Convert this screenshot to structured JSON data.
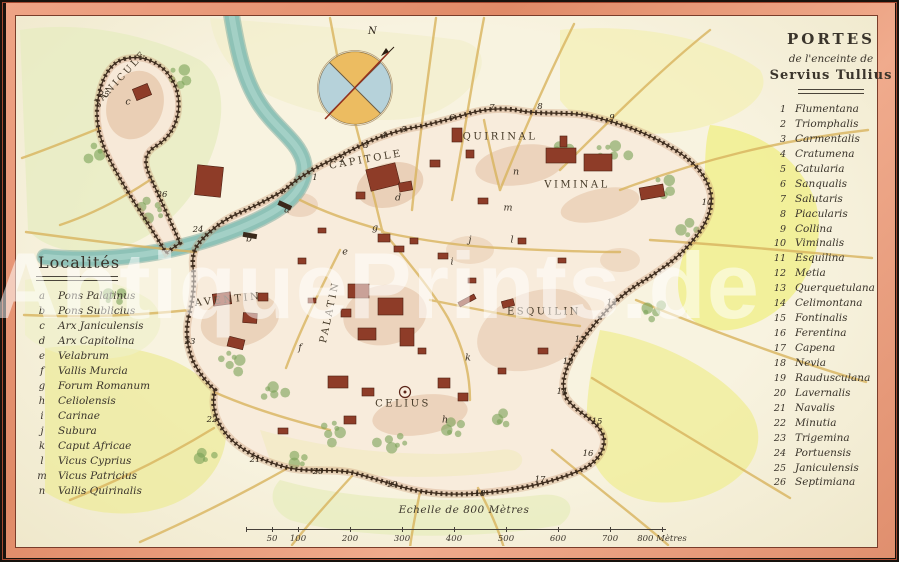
{
  "watermark": "AntiquePrints.de",
  "compass": {
    "north_label": "N"
  },
  "portes": {
    "title": "PORTES",
    "subtitle": "de l'enceinte de",
    "name": "Servius Tullius",
    "items": [
      {
        "n": "1",
        "name": "Flumentana"
      },
      {
        "n": "2",
        "name": "Triomphalis"
      },
      {
        "n": "3",
        "name": "Carmentalis"
      },
      {
        "n": "4",
        "name": "Cratumena"
      },
      {
        "n": "5",
        "name": "Catularia"
      },
      {
        "n": "6",
        "name": "Sanqualis"
      },
      {
        "n": "7",
        "name": "Salutaris"
      },
      {
        "n": "8",
        "name": "Piacularis"
      },
      {
        "n": "9",
        "name": "Collina"
      },
      {
        "n": "10",
        "name": "Viminalis"
      },
      {
        "n": "11",
        "name": "Esquilina"
      },
      {
        "n": "12",
        "name": "Metia"
      },
      {
        "n": "13",
        "name": "Querquetulana"
      },
      {
        "n": "14",
        "name": "Celimontana"
      },
      {
        "n": "15",
        "name": "Fontinalis"
      },
      {
        "n": "16",
        "name": "Ferentina"
      },
      {
        "n": "17",
        "name": "Capena"
      },
      {
        "n": "18",
        "name": "Nevia"
      },
      {
        "n": "19",
        "name": "Raudusculana"
      },
      {
        "n": "20",
        "name": "Lavernalis"
      },
      {
        "n": "21",
        "name": "Navalis"
      },
      {
        "n": "22",
        "name": "Minutia"
      },
      {
        "n": "23",
        "name": "Trigemina"
      },
      {
        "n": "24",
        "name": "Portuensis"
      },
      {
        "n": "25",
        "name": "Janiculensis"
      },
      {
        "n": "26",
        "name": "Septimiana"
      }
    ]
  },
  "localites": {
    "title": "Localités",
    "items": [
      {
        "letter": "a",
        "name": "Pons Palatinus"
      },
      {
        "letter": "b",
        "name": "Pons Sublicius"
      },
      {
        "letter": "c",
        "name": "Arx Janiculensis"
      },
      {
        "letter": "d",
        "name": "Arx Capitolina"
      },
      {
        "letter": "e",
        "name": "Velabrum"
      },
      {
        "letter": "f",
        "name": "Vallis Murcia"
      },
      {
        "letter": "g",
        "name": "Forum Romanum"
      },
      {
        "letter": "h",
        "name": "Celiolensis"
      },
      {
        "letter": "i",
        "name": "Carinae"
      },
      {
        "letter": "j",
        "name": "Subura"
      },
      {
        "letter": "k",
        "name": "Caput Africae"
      },
      {
        "letter": "l",
        "name": "Vicus Cyprius"
      },
      {
        "letter": "m",
        "name": "Vicus Patricius"
      },
      {
        "letter": "n",
        "name": "Vallis Quirinalis"
      }
    ]
  },
  "map": {
    "labels": [
      {
        "id": "janicule",
        "text": "JANICULE"
      },
      {
        "id": "capitole",
        "text": "CAPITOLE"
      },
      {
        "id": "quirinal",
        "text": "QUIRINAL"
      },
      {
        "id": "viminal",
        "text": "VIMINAL"
      },
      {
        "id": "esquilin",
        "text": "ESQUILIN"
      },
      {
        "id": "aventin",
        "text": "AVENTIN"
      },
      {
        "id": "palatin",
        "text": "PALATIN"
      },
      {
        "id": "celius",
        "text": "CELIUS"
      }
    ],
    "gate_numbers": [
      {
        "n": "1",
        "x": 315,
        "y": 178
      },
      {
        "n": "2",
        "x": 342,
        "y": 160
      },
      {
        "n": "3",
        "x": 366,
        "y": 146
      },
      {
        "n": "4",
        "x": 384,
        "y": 136
      },
      {
        "n": "5",
        "x": 404,
        "y": 130
      },
      {
        "n": "6",
        "x": 452,
        "y": 118
      },
      {
        "n": "7",
        "x": 492,
        "y": 108
      },
      {
        "n": "8",
        "x": 540,
        "y": 107
      },
      {
        "n": "9",
        "x": 612,
        "y": 118
      },
      {
        "n": "10",
        "x": 707,
        "y": 203
      },
      {
        "n": "11",
        "x": 612,
        "y": 303
      },
      {
        "n": "12",
        "x": 580,
        "y": 340
      },
      {
        "n": "13",
        "x": 568,
        "y": 362
      },
      {
        "n": "14",
        "x": 562,
        "y": 392
      },
      {
        "n": "15",
        "x": 597,
        "y": 422
      },
      {
        "n": "16",
        "x": 588,
        "y": 454
      },
      {
        "n": "17",
        "x": 540,
        "y": 480
      },
      {
        "n": "18",
        "x": 480,
        "y": 494
      },
      {
        "n": "19",
        "x": 392,
        "y": 485
      },
      {
        "n": "20",
        "x": 318,
        "y": 472
      },
      {
        "n": "21",
        "x": 255,
        "y": 460
      },
      {
        "n": "22",
        "x": 212,
        "y": 420
      },
      {
        "n": "23",
        "x": 190,
        "y": 342
      },
      {
        "n": "24",
        "x": 198,
        "y": 230
      },
      {
        "n": "25",
        "x": 104,
        "y": 95
      },
      {
        "n": "26",
        "x": 162,
        "y": 195
      }
    ],
    "letter_markers": [
      {
        "l": "a",
        "x": 287,
        "y": 210
      },
      {
        "l": "b",
        "x": 249,
        "y": 239
      },
      {
        "l": "c",
        "x": 128,
        "y": 102
      },
      {
        "l": "d",
        "x": 398,
        "y": 198
      },
      {
        "l": "e",
        "x": 345,
        "y": 252
      },
      {
        "l": "f",
        "x": 300,
        "y": 348
      },
      {
        "l": "g",
        "x": 375,
        "y": 228
      },
      {
        "l": "h",
        "x": 445,
        "y": 420
      },
      {
        "l": "i",
        "x": 452,
        "y": 262
      },
      {
        "l": "j",
        "x": 470,
        "y": 240
      },
      {
        "l": "k",
        "x": 468,
        "y": 358
      },
      {
        "l": "l",
        "x": 512,
        "y": 240
      },
      {
        "l": "m",
        "x": 508,
        "y": 208
      },
      {
        "l": "n",
        "x": 516,
        "y": 172
      }
    ]
  },
  "scale": {
    "caption": "Echelle de 800 Mètres",
    "ticks": [
      "50",
      "100",
      "200",
      "300",
      "400",
      "500",
      "600",
      "700",
      "800 Mètres"
    ]
  },
  "colors": {
    "border_salmon": "#e8906e",
    "paper": "#f5efd8",
    "river": "#8cc1b6",
    "wall": "#3a281a",
    "building": "#8e3c28",
    "road": "#d9b45e",
    "wash_yellow": "#f1ee8e",
    "wash_green": "#e7ecc2",
    "tree": "#7aa257",
    "compass_orange": "#eab34b",
    "compass_blue": "#a6cbd9",
    "ink": "#3a342b"
  }
}
